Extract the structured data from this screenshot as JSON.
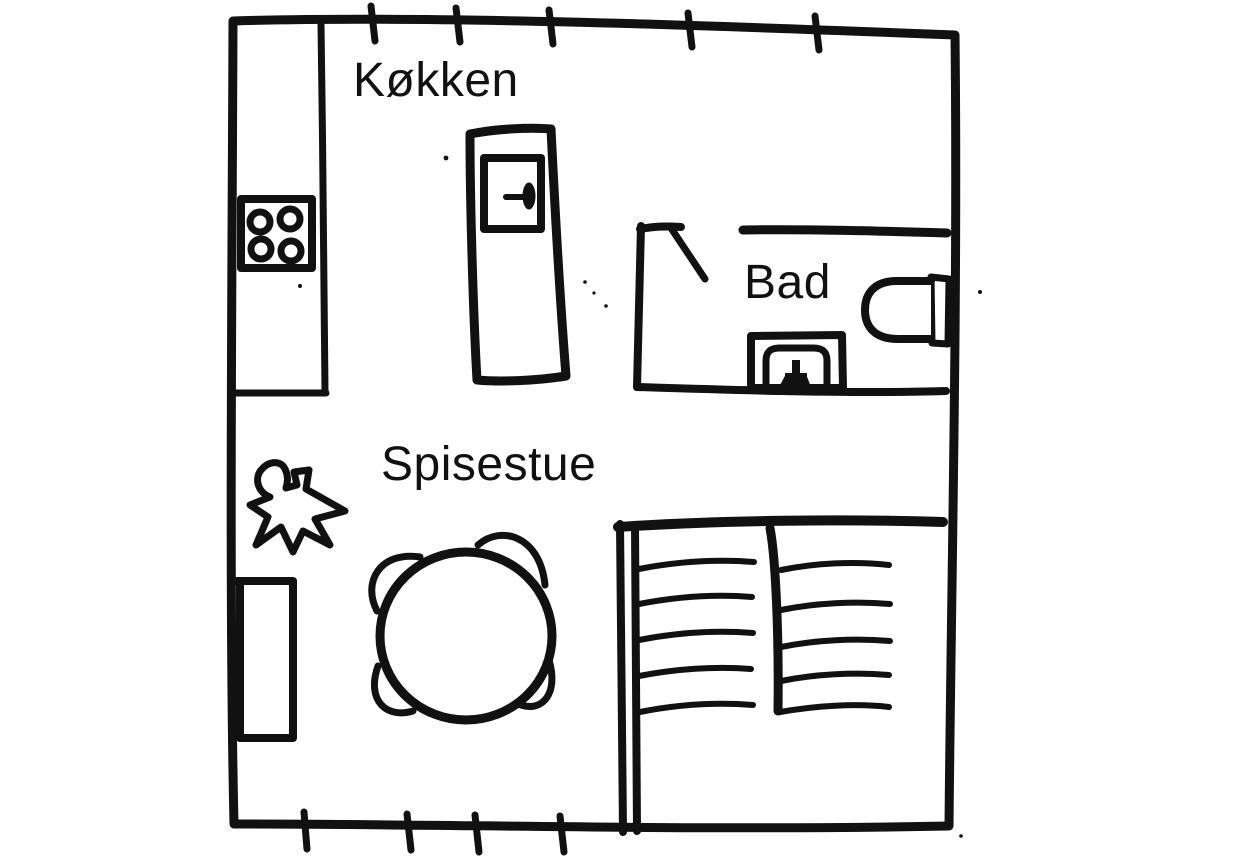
{
  "floorplan": {
    "background_color": "#ffffff",
    "ink_color": "#111111",
    "rooms": [
      {
        "id": "kitchen",
        "label": "Køkken"
      },
      {
        "id": "bathroom",
        "label": "Bad"
      },
      {
        "id": "dining-room",
        "label": "Spisestue"
      }
    ],
    "fixtures": [
      {
        "name": "stove-icon",
        "room": "kitchen",
        "burners": 4
      },
      {
        "name": "counter-icon",
        "room": "kitchen"
      },
      {
        "name": "door-icon",
        "room": "kitchen"
      },
      {
        "name": "door-swing-icon",
        "room": "bathroom"
      },
      {
        "name": "toilet-icon",
        "room": "bathroom"
      },
      {
        "name": "washbasin-icon",
        "room": "bathroom"
      },
      {
        "name": "dining-table-icon",
        "room": "dining-room",
        "chairs": 4
      },
      {
        "name": "sideboard-icon",
        "room": "dining-room"
      },
      {
        "name": "staircase-icon",
        "room": "dining-room",
        "flights": 2,
        "treads_per_flight": 5
      },
      {
        "name": "starburst-icon",
        "room": "dining-room"
      }
    ],
    "wall_tick_marks": {
      "top_edge": 5,
      "bottom_edge": 4
    }
  }
}
